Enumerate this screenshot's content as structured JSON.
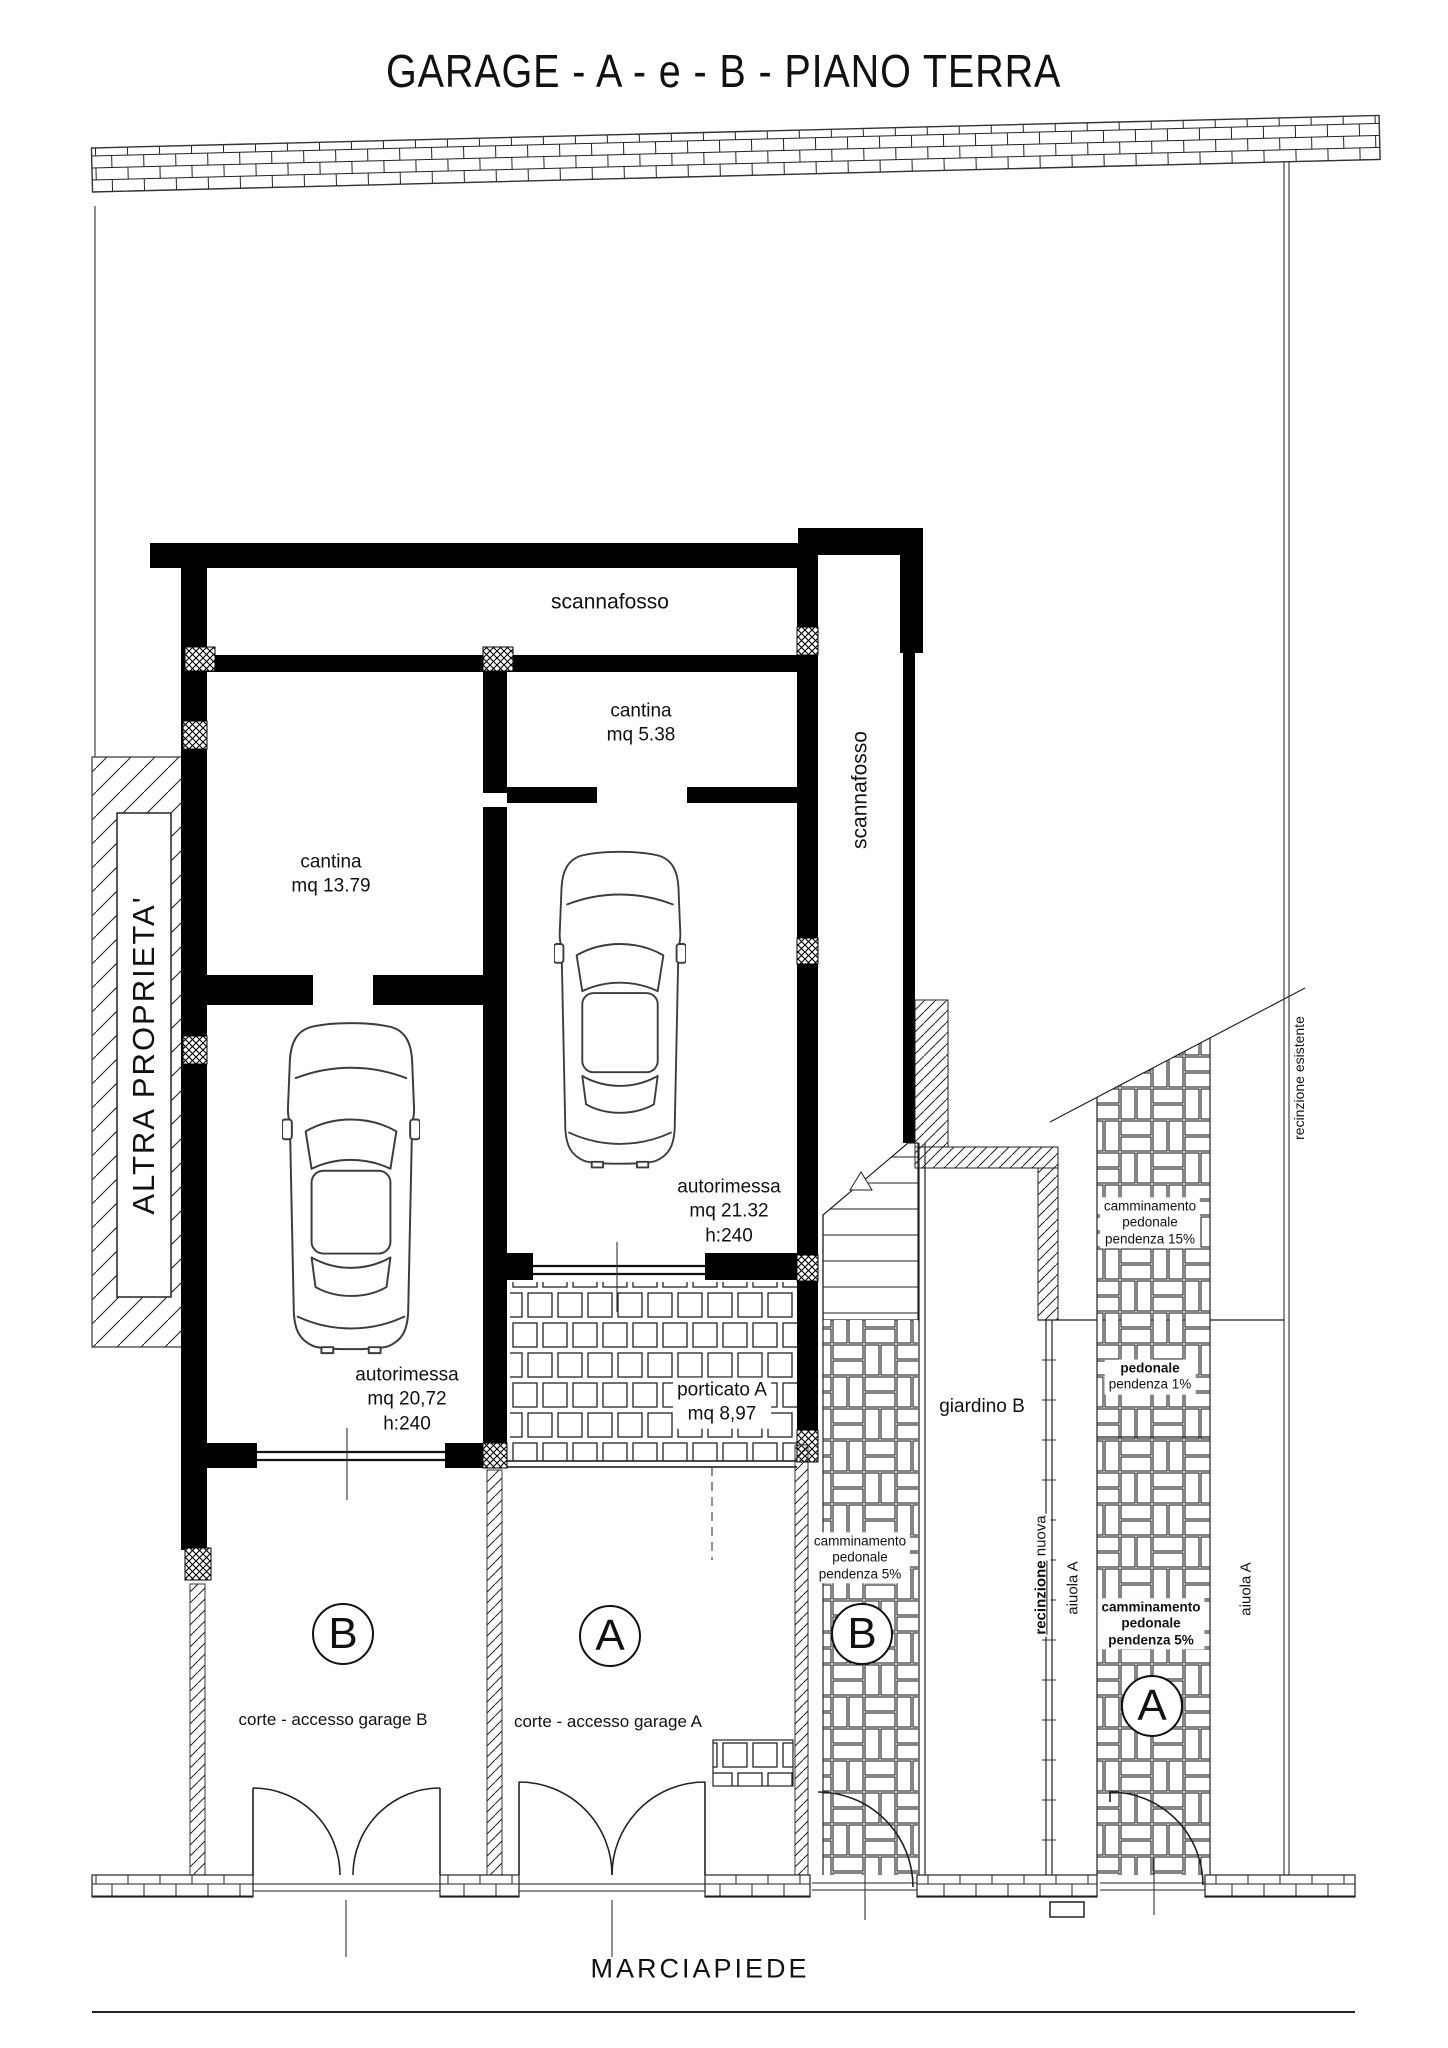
{
  "title": "GARAGE - A - e - B - PIANO TERRA",
  "rooms": {
    "scannafosso_top": "scannafosso",
    "scannafosso_side": "scannafosso",
    "cantina_a": [
      "cantina",
      "mq 5.38"
    ],
    "cantina_b": [
      "cantina",
      "mq 13.79"
    ],
    "autorimessa_a": [
      "autorimessa",
      "mq 21.32",
      "h:240"
    ],
    "autorimessa_b": [
      "autorimessa",
      "mq 20,72",
      "h:240"
    ],
    "porticato_a": [
      "porticato A",
      "mq 8,97"
    ],
    "giardino_b": "giardino B",
    "corte_a": "corte - accesso garage A",
    "corte_b": "corte - accesso garage B"
  },
  "site": {
    "altra_proprieta": "ALTRA PROPRIETA'",
    "marciapiede": "MARCIAPIEDE",
    "recinzione_nuova": [
      "recinzione",
      "nuova"
    ],
    "recinzione_esistente": "recinzione esistente",
    "aiuola_left": "aiuola A",
    "aiuola_right": "aiuola A"
  },
  "paths": {
    "camminamento_15": [
      "camminamento",
      "pedonale",
      "pendenza 15%"
    ],
    "pedonale_1": [
      "pedonale",
      "pendenza 1%"
    ],
    "camminamento_5_b": [
      "camminamento",
      "pedonale",
      "pendenza 5%"
    ],
    "camminamento_5_a": [
      "camminamento",
      "pedonale",
      "pendenza 5%"
    ]
  },
  "markers": {
    "corte_b": "B",
    "corte_a": "A",
    "path_b": "B",
    "path_a": "A"
  },
  "colors": {
    "line": "#1a1a1a",
    "wall": "#000000",
    "background": "#ffffff"
  }
}
